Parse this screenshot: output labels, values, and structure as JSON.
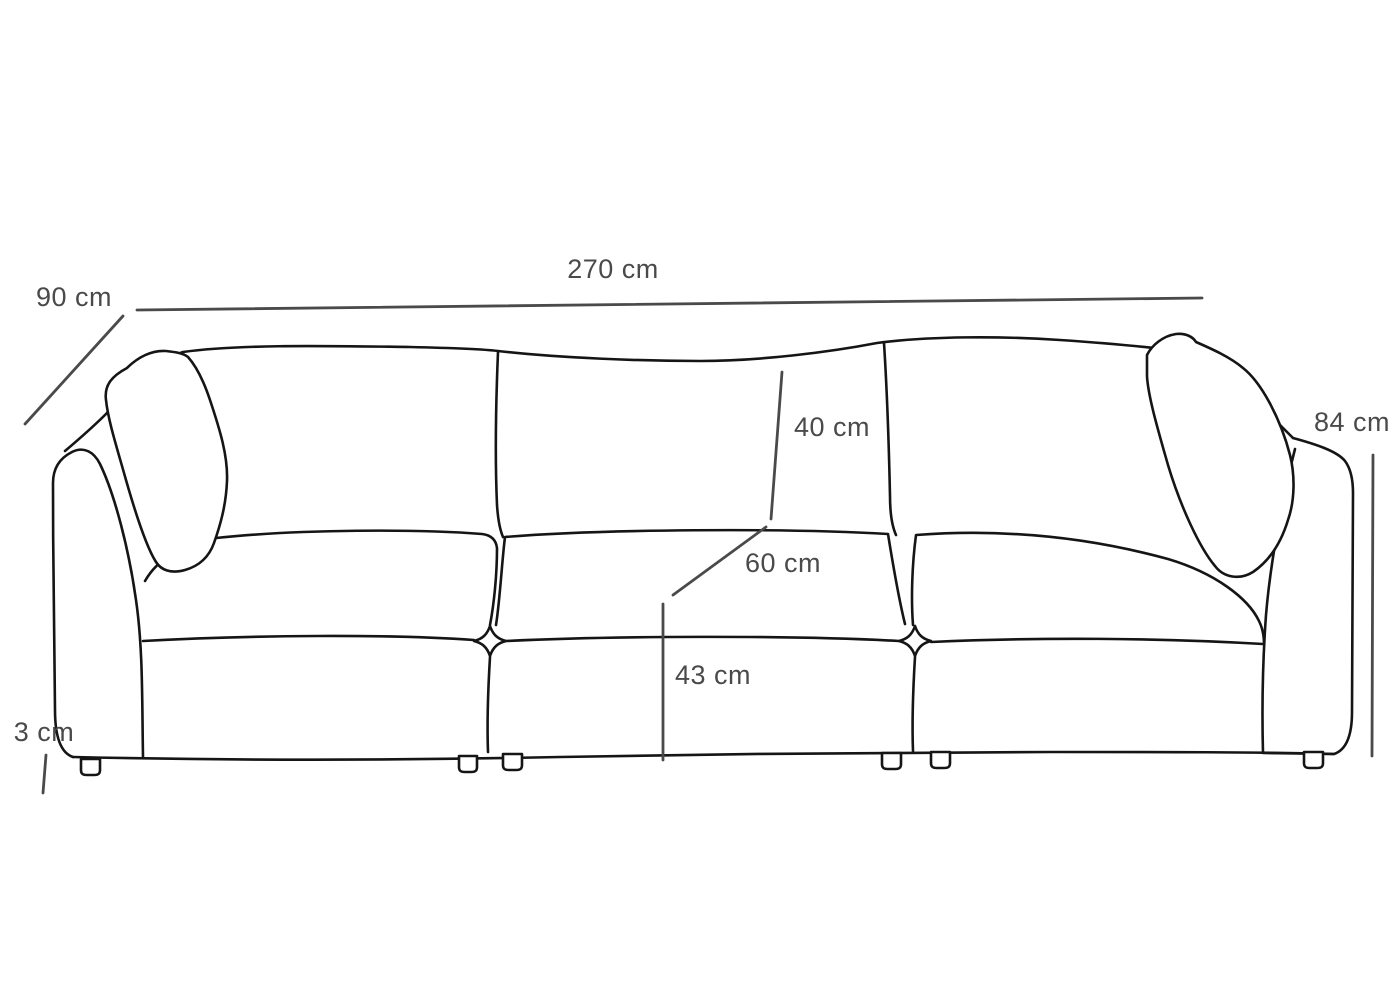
{
  "diagram": {
    "name": "modular-sofa-dimension-diagram",
    "background": "#ffffff",
    "outline_color": "#151515",
    "dimension_color": "#4a4a4a",
    "dimensions": {
      "overall_width": "270 cm",
      "depth": "90 cm",
      "overall_height": "84 cm",
      "back_cushion_height": "40 cm",
      "seat_depth": "60 cm",
      "seat_height": "43 cm",
      "leg_height": "3 cm"
    }
  }
}
